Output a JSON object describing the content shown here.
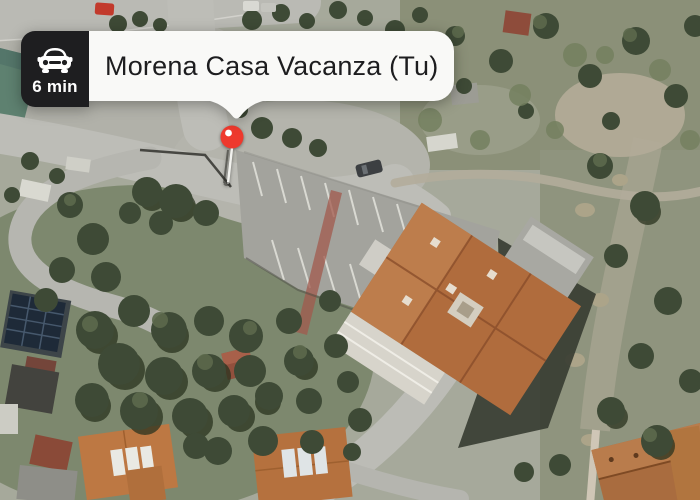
{
  "callout": {
    "title": "Morena Casa Vacanza (Tu)",
    "badge": {
      "travel_time": "6 min",
      "icon": "car-icon",
      "bg_color": "#1e1e20",
      "text_color": "#ffffff"
    },
    "bubble_bg_color": "#f9f9f7",
    "title_color": "#1d1d1f"
  },
  "pin": {
    "label": "destination-pin",
    "color": "#ee392d",
    "dot_color": "#ffffff"
  }
}
